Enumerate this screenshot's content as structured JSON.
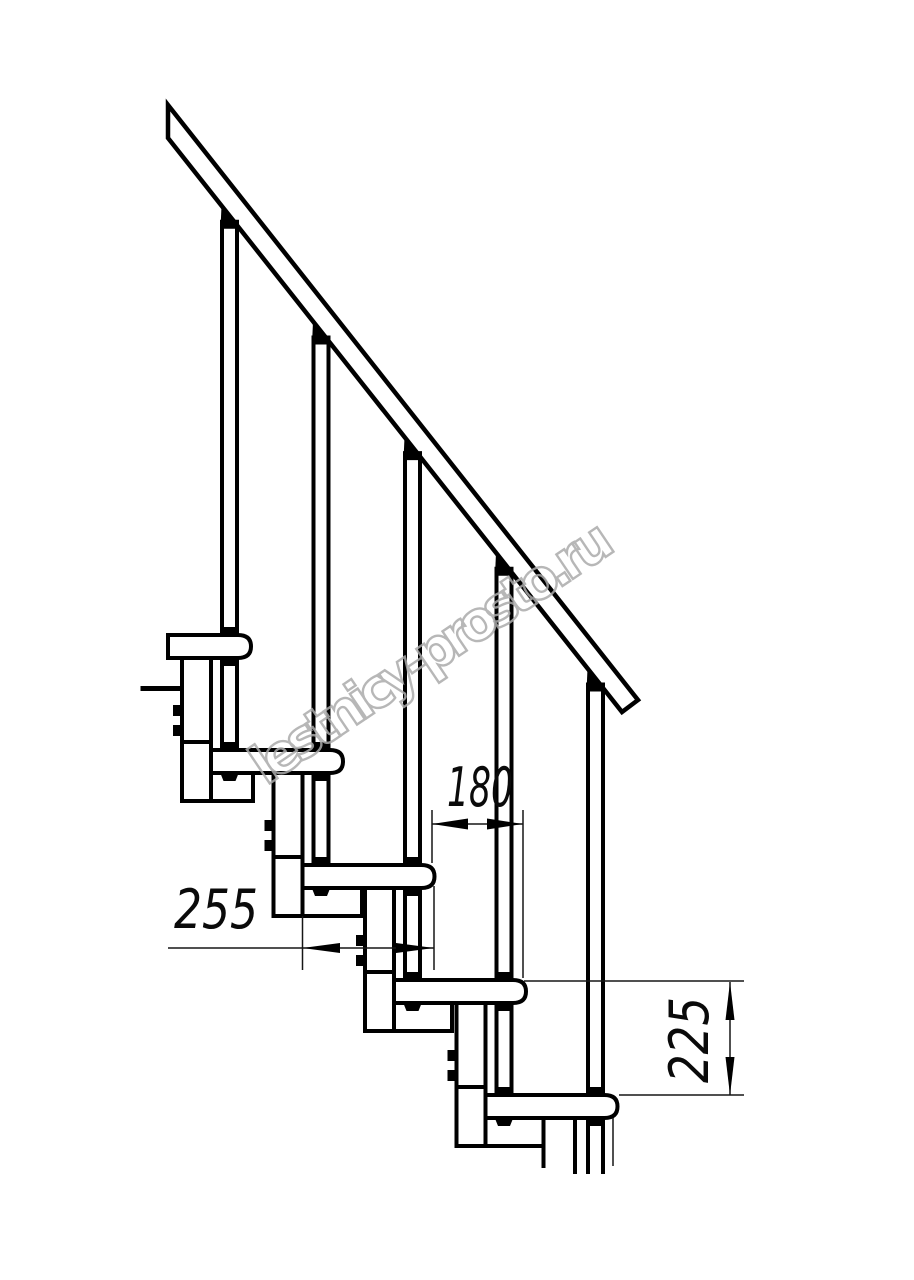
{
  "watermark": {
    "text": "lestnicy-prosto.ru",
    "color": "#ababab"
  },
  "dimensions": {
    "going": {
      "label": "180",
      "value_mm": 180
    },
    "tread_depth": {
      "label": "255",
      "value_mm": 255
    },
    "rise": {
      "label": "225",
      "value_mm": 225
    }
  },
  "drawing": {
    "steps_visible": 5,
    "balusters_visible": 5,
    "line_color": "#000000",
    "background_color": "#ffffff",
    "watermark_color": "#ababab"
  },
  "structure": {
    "rail": {
      "x0": 168,
      "y_top0": 105,
      "y_bot0": 138,
      "slope": 1.2643
    },
    "tread_height": 23,
    "treads": [
      {
        "left": 168,
        "right": 251,
        "top": 635
      },
      {
        "left": 211,
        "right": 343,
        "top": 750
      },
      {
        "left": 302.5,
        "right": 434.5,
        "top": 865
      },
      {
        "left": 394,
        "right": 526,
        "top": 980
      },
      {
        "left": 485.5,
        "right": 617.5,
        "top": 1095
      }
    ],
    "columns": [
      {
        "x": 182,
        "top": 658,
        "w": 29,
        "h": 143,
        "box_right": 253
      },
      {
        "x": 273.5,
        "top": 773,
        "w": 29,
        "h": 143,
        "box_right": 362
      },
      {
        "x": 365,
        "top": 888,
        "w": 29,
        "h": 143,
        "box_right": 452
      },
      {
        "x": 456.5,
        "top": 1003,
        "w": 29,
        "h": 143,
        "box_right": 543.5
      }
    ],
    "bolts": [
      229.5,
      321,
      412.5,
      504,
      595.5
    ],
    "drawing_bottom": 1172
  }
}
